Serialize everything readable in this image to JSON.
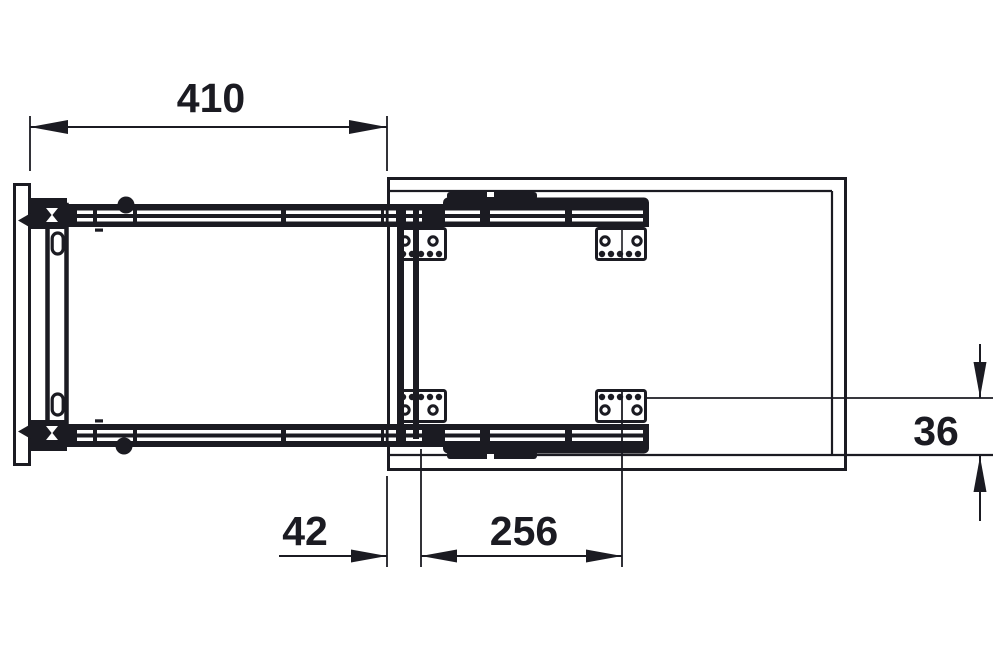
{
  "drawing": {
    "kind": "pull-out-slide-top-view-technical-drawing",
    "dimensions": {
      "d410": {
        "label": "410"
      },
      "d42": {
        "label": "42"
      },
      "d256": {
        "label": "256"
      },
      "d36": {
        "label": "36"
      }
    },
    "colors": {
      "ink": "#1b1b22",
      "background": "#ffffff"
    }
  }
}
